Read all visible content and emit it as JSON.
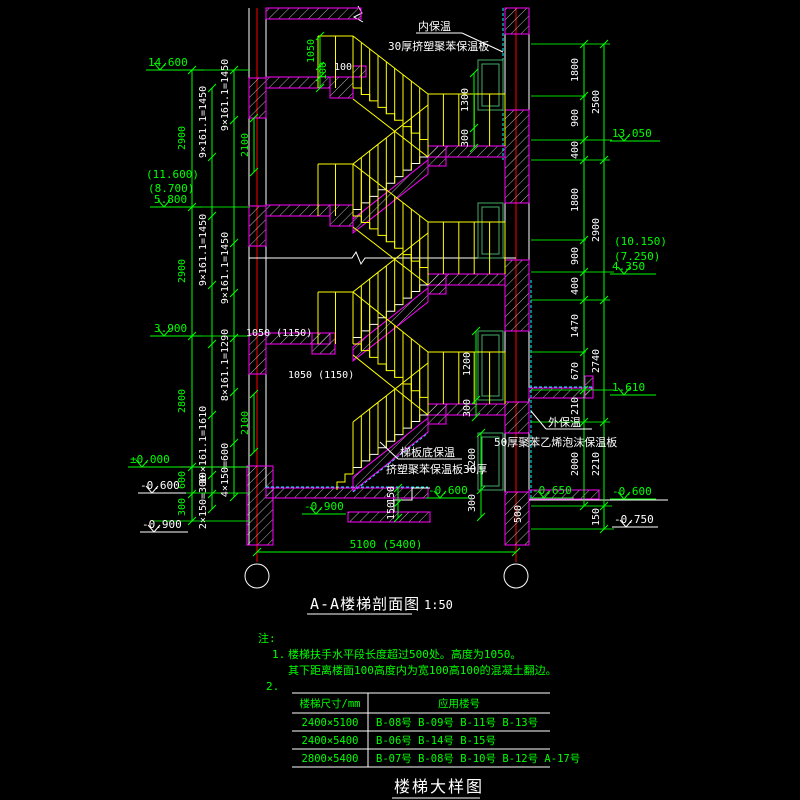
{
  "drawing": {
    "section_title": "A-A楼梯剖面图",
    "section_scale": "1:50",
    "detail_title": "楼梯大样图"
  },
  "annotations": {
    "inner_insulation": "内保温",
    "inner_insulation_board": "30厚挤塑聚苯保温板",
    "flight_soffit_insulation": "梯板底保温",
    "flight_soffit_board": "挤塑聚苯保温板30厚",
    "outer_insulation": "外保温",
    "outer_insulation_board": "50厚聚苯乙烯泡沫保温板"
  },
  "levels": {
    "l14_600": "14.600",
    "l11_600": "(11.600)",
    "l8_700": "(8.700)",
    "l5_800": "5.800",
    "l3_900": "3.900",
    "l0_000": "±0.000",
    "lm0_600": "-0.600",
    "lm0_900": "-0.900",
    "l13_050": "13.050",
    "l10_150": "(10.150)",
    "l7_250": "(7.250)",
    "l4_350": "4.350",
    "l1_610": "1.610",
    "lm0_650": "-0.650",
    "lm0_750": "-0.750"
  },
  "dims": {
    "floor_2900": "2900",
    "floor_2800": "2800",
    "v600": "600",
    "v300": "300",
    "flight_9": "9×161.1=1450",
    "flight_8": "8×161.1=1290",
    "flight_10": "10×161.1=1610",
    "steps_4": "4×150=600",
    "steps_2": "2×150=300",
    "v2100": "2100",
    "rail_1050": "1050",
    "v100": "100",
    "landing_1050": "1050 (1150)",
    "total_width": "5100 (5400)",
    "win_1300": "1300",
    "win_1200": "1200",
    "win_300": "300",
    "r1800": "1800",
    "r900": "900",
    "r400": "400",
    "r1470": "1470",
    "r670": "670",
    "r210": "210",
    "r2000": "2000",
    "r2500": "2500",
    "r2900": "2900",
    "r2740": "2740",
    "r2210": "2210",
    "r150": "150",
    "r500": "500"
  },
  "notes": {
    "heading": "注:",
    "item1_no": "1.",
    "item1_line1": "楼梯扶手水平段长度超过500处。高度为1050。",
    "item1_line2": "其下距离楼面100高度内为宽100高100的混凝土翻边。",
    "item2_no": "2."
  },
  "table": {
    "col1_header": "楼梯尺寸/mm",
    "col2_header": "应用楼号",
    "rows": [
      {
        "size": "2400×5100",
        "buildings": "B-08号  B-09号  B-11号  B-13号"
      },
      {
        "size": "2400×5400",
        "buildings": "B-06号  B-14号  B-15号"
      },
      {
        "size": "2800×5400",
        "buildings": "B-07号  B-08号  B-10号  B-12号  A-17号"
      }
    ]
  }
}
